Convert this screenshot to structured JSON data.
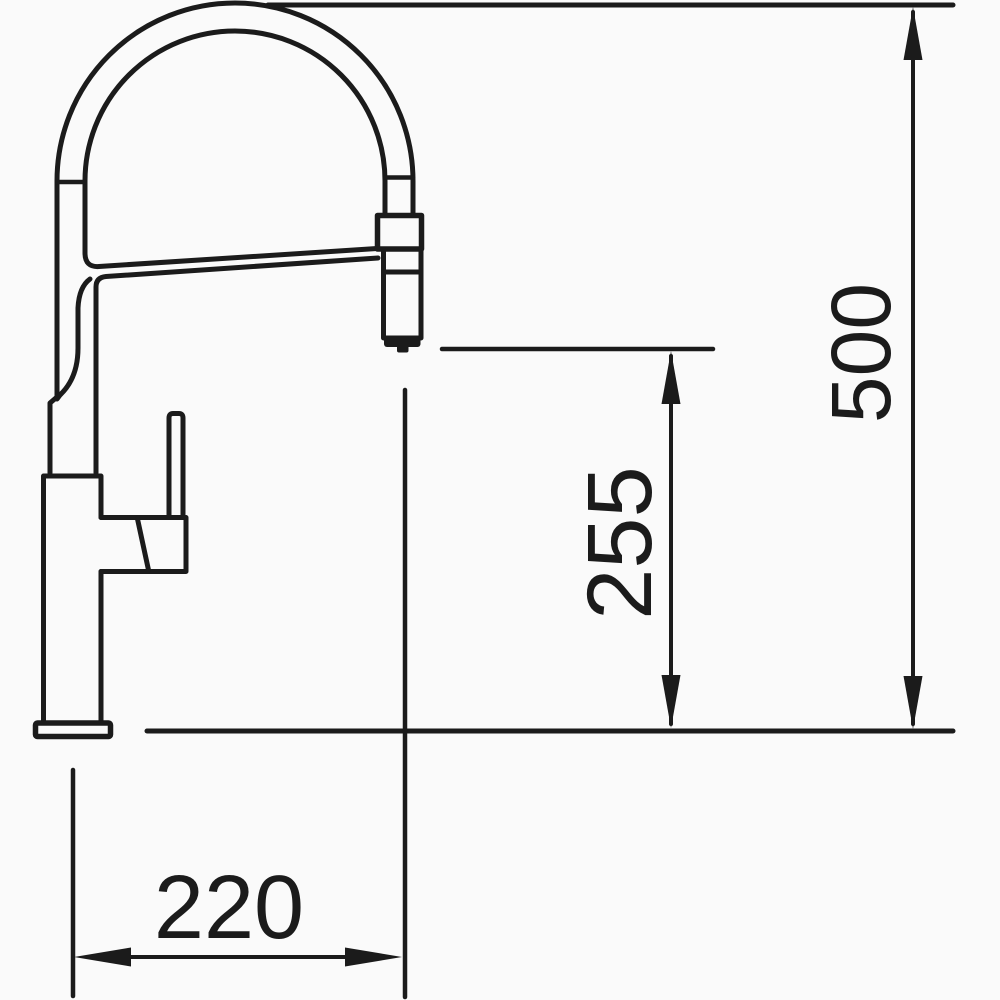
{
  "page": {
    "background": "#fafafa",
    "line_color": "#1b1b1b"
  },
  "drawing": {
    "type": "technical-dimension-drawing",
    "subject": "kitchen faucet side elevation with pull-down spray head",
    "dimensions": [
      {
        "id": "overall-height",
        "label": "500",
        "orientation": "vertical"
      },
      {
        "id": "spout-to-base-height",
        "label": "255",
        "orientation": "vertical"
      },
      {
        "id": "spout-reach",
        "label": "220",
        "orientation": "horizontal"
      }
    ]
  }
}
